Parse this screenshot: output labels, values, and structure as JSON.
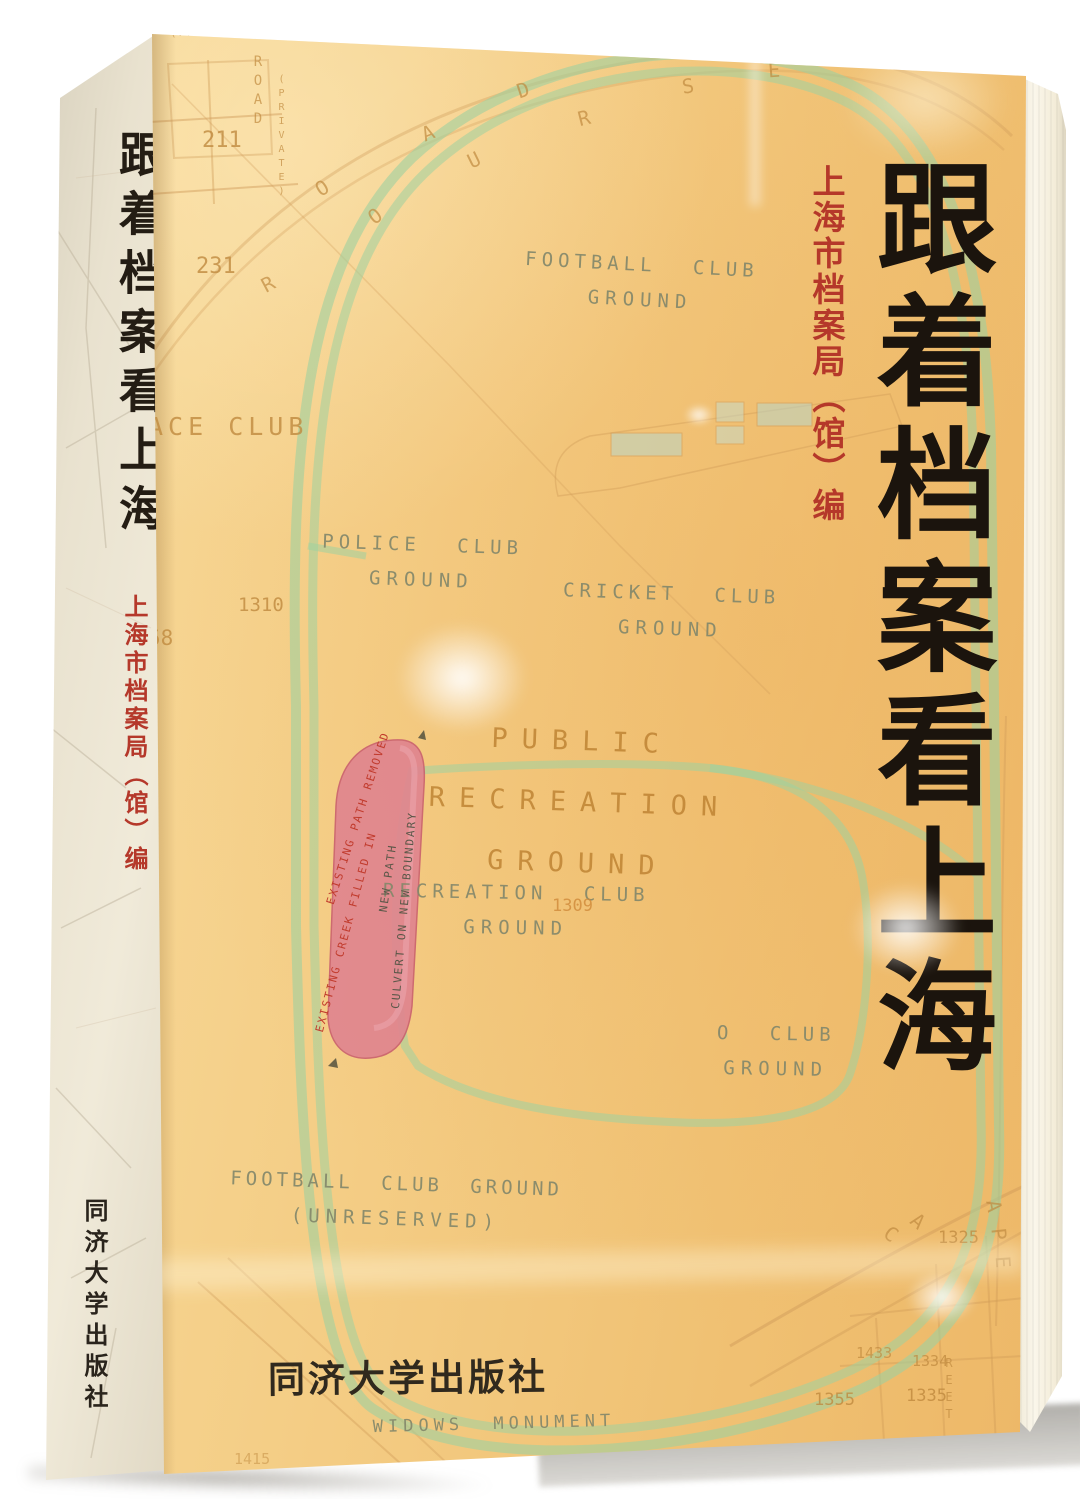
{
  "book": {
    "title": "跟着档案看上海",
    "author": "上海市档案局（馆）编",
    "publisher": "同济大学出版社"
  },
  "spine": {
    "title": "跟着档案看上海",
    "author": "上海市档案局（馆）编",
    "publisher": "同济大学出版社"
  },
  "cover": {
    "title": "跟着档案看上海",
    "author": "上海市档案局（馆）编",
    "publisher": "同济大学出版社"
  },
  "map": {
    "labels": {
      "football_top": {
        "line1": "FOOTBALL CLUB",
        "line2": "GROUND"
      },
      "police": {
        "line1": "POLICE CLUB",
        "line2": "GROUND"
      },
      "cricket": {
        "line1": "CRICKET CLUB",
        "line2": "GROUND"
      },
      "public_recreation": {
        "line1": "PUBLIC",
        "line2": "RECREATION",
        "line3": "GROUND"
      },
      "recreation_club": {
        "line1": "RECREATION CLUB",
        "line2": "GROUND",
        "number": "1309"
      },
      "club_right": {
        "line1": "O CLUB",
        "line2": "GROUND"
      },
      "football_unreserved": {
        "line1": "FOOTBALL CLUB GROUND",
        "line2": "(UNRESERVED)"
      },
      "widows": "WIDOWS MONUMENT",
      "race_club": "ACE CLUB",
      "private_top": "(PRIVATE.)",
      "road_vertical": "ROAD",
      "private_vertical": "(PRIVATE)",
      "street_vertical": "REET"
    },
    "annotations": {
      "existing_path": "EXISTING PATH REMOVED",
      "existing_creek": "EXISTING CREEK FILLED IN",
      "new_path": "NEW PATH",
      "culvert": "CULVERT ON NEW BOUNDARY"
    },
    "numbers": [
      "211",
      "231",
      "1310",
      "58",
      "1415",
      "0",
      "1325",
      "1433",
      "1334",
      "1335",
      "1355"
    ],
    "curve_letters": [
      "O",
      "O",
      "R",
      "A",
      "U",
      "D",
      "R",
      "S",
      "E",
      "C",
      "A",
      "A",
      "P",
      "E"
    ]
  },
  "colors": {
    "cover_bg": "#f2c77d",
    "track_green": "#9ed1a0",
    "map_label_grey": "#84886b",
    "map_accent_brown": "#bf8434",
    "title_black": "#1b140d",
    "author_red": "#b5382a",
    "pink_strip": "#e0838f",
    "spine_bg": "#e9e2cf",
    "page_edge": "#faf6ea"
  }
}
